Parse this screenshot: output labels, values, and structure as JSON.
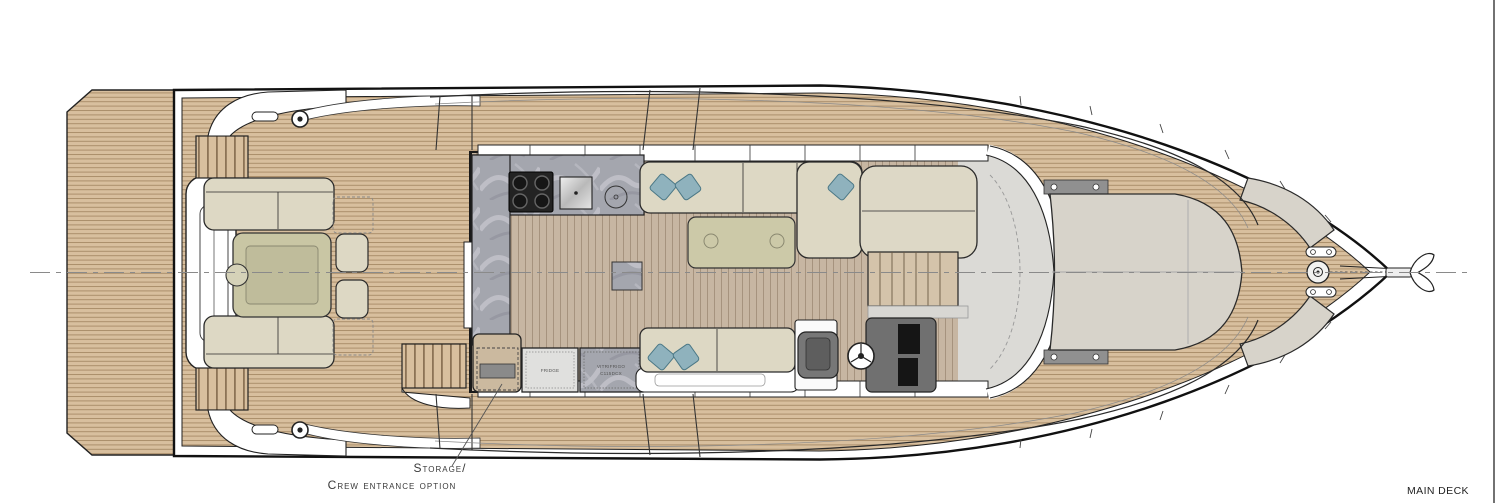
{
  "drawing": {
    "type": "yacht floor plan, top view",
    "deck_name": "MAIN DECK"
  },
  "labels": {
    "storage_line1": "Storage/",
    "storage_line2": "Crew entrance option",
    "deck_name": "MAIN DECK"
  },
  "galley": {
    "fridge_label": "FRIDGE",
    "fridge2_label_line1": "VITRIFRIGO",
    "fridge2_label_line2": "C115DCX",
    "cooktop_burners": 4
  },
  "icons": [
    "anchor-icon",
    "windlass-icon",
    "steering-wheel-icon",
    "cooktop-icon",
    "sink-icon",
    "cleat-icon"
  ],
  "colors": {
    "paper": "#ffffff",
    "teak": "#d8bf9e",
    "teak_line": "#ab8f6b",
    "interior_floor": "#c7b6a2",
    "interior_floor_line": "#a6937e",
    "marble": "#a4a6ae",
    "upholstery": "#ddd8c4",
    "table_olive": "#c9c6a4",
    "pillow_teal": "#8fb2bd",
    "sunpad_gray": "#d7d3ca",
    "helm_gray": "#707070",
    "outline": "#1a1a1a",
    "centerline_gray": "#8a8a8a"
  }
}
